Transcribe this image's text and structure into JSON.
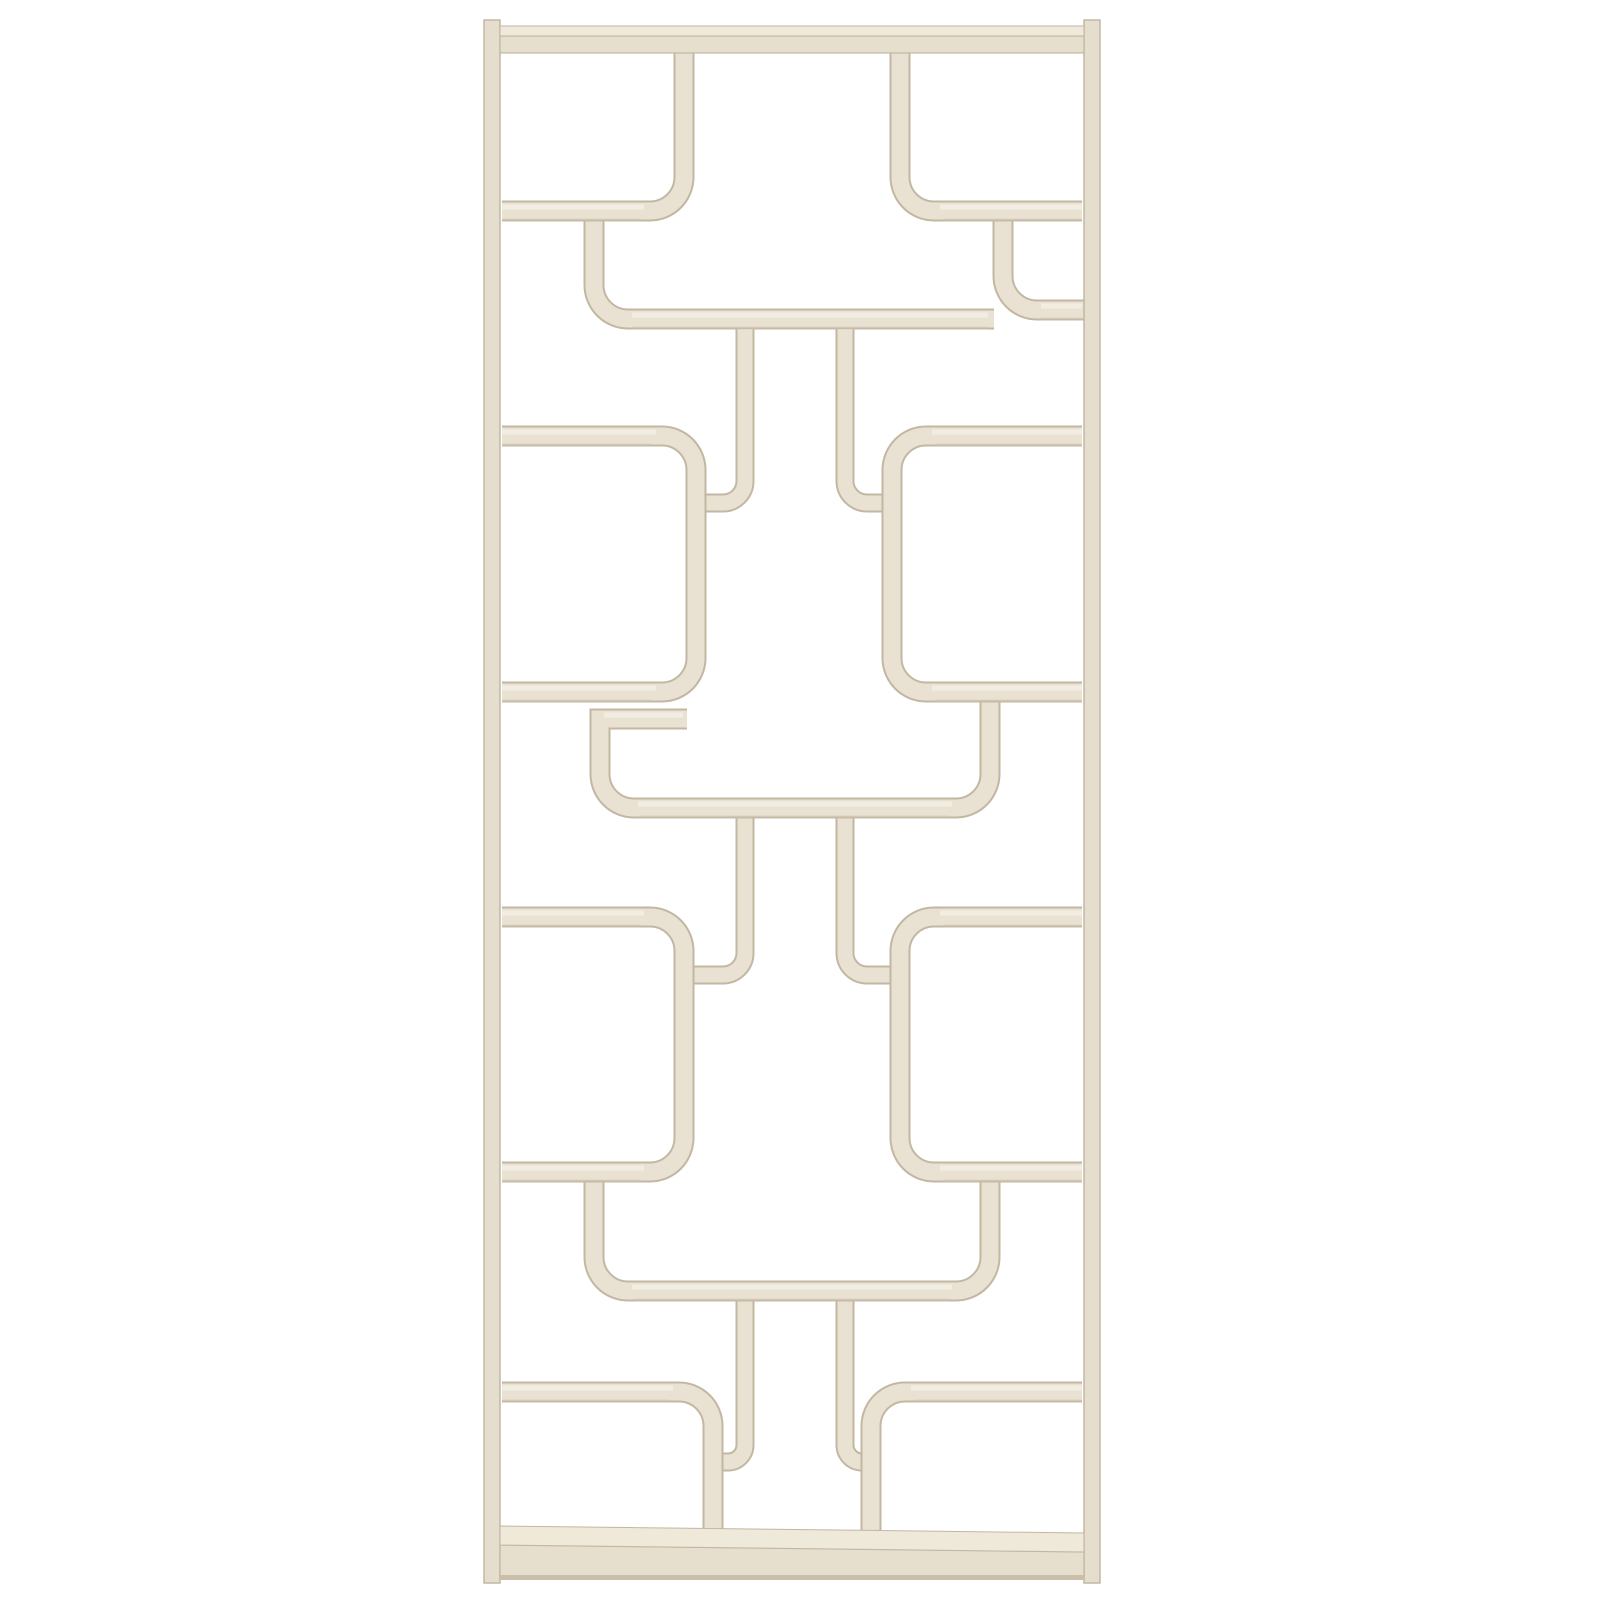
{
  "meta": {
    "subject": "White painted bentwood room divider shelving unit, mid-century modern, product photo on plain white background",
    "canvas_width": 1600,
    "canvas_height": 1600
  },
  "palette": {
    "background": "#ffffff",
    "wood_face": "#e9e2d3",
    "wood_rail": "#e5ddcd",
    "wood_edge": "#c2b7a2",
    "wood_top_face": "#f3efe4",
    "wood_under_shade": "#cdc2ae",
    "bar_top_face": "#efe9da",
    "bar_front_face": "#e7dfce",
    "bar_base": "#c9bfab"
  },
  "divider": {
    "stroke_widths": {
      "shelf": 17,
      "post": 15,
      "outline_extra": 4
    },
    "frame": {
      "rails": [
        {
          "name": "frame-rail-left",
          "x": 484,
          "y": 20,
          "w": 16,
          "h": 1563
        },
        {
          "name": "frame-rail-right",
          "x": 1084,
          "y": 20,
          "w": 16,
          "h": 1563
        }
      ],
      "top_bar": {
        "top_face": {
          "x": 500,
          "y": 26,
          "w": 584,
          "h": 10
        },
        "front_face": {
          "x": 500,
          "y": 36,
          "w": 584,
          "h": 17
        }
      },
      "bottom_bar": {
        "top_face_points": "500,1526 1084,1533 1084,1552 500,1545",
        "front_face_points": "500,1545 1084,1552 1084,1577 500,1577",
        "base": {
          "x": 500,
          "y": 1575,
          "w": 584,
          "h": 5
        }
      }
    },
    "pieces": [
      {
        "name": "band1-hanging-shelf",
        "w": 17,
        "d": "M 594 219 L 594 285 A 34 34 0 0 0 628 319 L 994 319"
      },
      {
        "name": "band1-rail-hook-right",
        "w": 17,
        "d": "M 1003 220 L 1003 276 A 34 34 0 0 0 1037 310 L 1086 310"
      },
      {
        "name": "band2-hook-post-left",
        "w": 15,
        "d": "M 745 329 L 745 481 A 22 22 0 0 1 723 503 L 705 503"
      },
      {
        "name": "band2-hook-post-right",
        "w": 15,
        "d": "M 845 329 L 845 481 A 22 22 0 0 0 867 503 L 883 503"
      },
      {
        "name": "band3-hook-post-left",
        "w": 15,
        "d": "M 745 818 L 745 953 A 22 22 0 0 1 723 975 L 694 975"
      },
      {
        "name": "band3-hook-post-right",
        "w": 15,
        "d": "M 845 818 L 845 953 A 22 22 0 0 0 867 975 L 890 975"
      },
      {
        "name": "band3-center-module",
        "w": 17,
        "d": "M 687 719 L 600 719 L 600 774 A 34 34 0 0 0 634 808 L 956 808 A 34 34 0 0 0 990 774 L 990 700"
      },
      {
        "name": "band5-hook-post-left",
        "w": 15,
        "d": "M 745 1300 L 745 1445 A 17 17 0 0 1 728 1462 L 722 1462"
      },
      {
        "name": "band5-hook-post-right",
        "w": 15,
        "d": "M 845 1300 L 845 1445 A 17 17 0 0 0 862 1462"
      },
      {
        "name": "band5-center-module",
        "w": 17,
        "d": "M 594 1181 L 594 1257 A 34 34 0 0 0 628 1291 L 956 1291 A 34 34 0 0 0 990 1257 L 990 1181"
      },
      {
        "name": "band2-shelf-unit-left",
        "w": 17,
        "d": "M 502 436 L 662 436 A 34 34 0 0 1 696 470 L 696 658 A 34 34 0 0 1 662 692 L 502 692"
      },
      {
        "name": "band2-shelf-unit-right",
        "w": 17,
        "d": "M 1082 436 L 926 436 A 34 34 0 0 0 892 470 L 892 658 A 34 34 0 0 0 926 692 L 1082 692"
      },
      {
        "name": "band4-shelf-unit-left",
        "w": 17,
        "d": "M 502 917 L 650 917 A 34 34 0 0 1 684 951 L 684 1138 A 34 34 0 0 1 650 1172 L 502 1172"
      },
      {
        "name": "band4-shelf-unit-right",
        "w": 17,
        "d": "M 1082 917 L 934 917 A 34 34 0 0 0 900 951 L 900 1138 A 34 34 0 0 0 934 1172 L 1082 1172"
      },
      {
        "name": "band1-shelf-post-left",
        "w": 17,
        "d": "M 502 211 L 650 211 A 34 34 0 0 0 684 177 L 684 50"
      },
      {
        "name": "band1-shelf-post-right",
        "w": 17,
        "d": "M 1082 211 L 934 211 A 34 34 0 0 1 900 177 L 900 50"
      },
      {
        "name": "band5-shelf-post-left",
        "w": 17,
        "d": "M 502 1392 L 679 1392 A 34 34 0 0 1 713 1426 L 713 1548"
      },
      {
        "name": "band5-shelf-post-right",
        "w": 17,
        "d": "M 1082 1392 L 905 1392 A 34 34 0 0 0 871 1426 L 871 1548"
      }
    ],
    "top_highlights": [
      {
        "y": 207,
        "x1": 502,
        "x2": 644
      },
      {
        "y": 207,
        "x1": 940,
        "x2": 1082
      },
      {
        "y": 315,
        "x1": 632,
        "x2": 988
      },
      {
        "y": 306,
        "x1": 1041,
        "x2": 1082
      },
      {
        "y": 432,
        "x1": 502,
        "x2": 656
      },
      {
        "y": 432,
        "x1": 932,
        "x2": 1082
      },
      {
        "y": 688,
        "x1": 502,
        "x2": 656
      },
      {
        "y": 688,
        "x1": 932,
        "x2": 1082
      },
      {
        "y": 715,
        "x1": 604,
        "x2": 683
      },
      {
        "y": 804,
        "x1": 638,
        "x2": 952
      },
      {
        "y": 913,
        "x1": 502,
        "x2": 644
      },
      {
        "y": 913,
        "x1": 940,
        "x2": 1082
      },
      {
        "y": 1168,
        "x1": 502,
        "x2": 644
      },
      {
        "y": 1168,
        "x1": 940,
        "x2": 1082
      },
      {
        "y": 1287,
        "x1": 632,
        "x2": 952
      },
      {
        "y": 1388,
        "x1": 502,
        "x2": 673
      },
      {
        "y": 1388,
        "x1": 911,
        "x2": 1082
      }
    ],
    "under_shadows": [
      {
        "y": 220,
        "x1": 502,
        "x2": 640
      },
      {
        "y": 220,
        "x1": 944,
        "x2": 1082
      },
      {
        "y": 328,
        "x1": 632,
        "x2": 988
      },
      {
        "y": 319,
        "x1": 1041,
        "x2": 1082
      },
      {
        "y": 445,
        "x1": 502,
        "x2": 652
      },
      {
        "y": 445,
        "x1": 936,
        "x2": 1082
      },
      {
        "y": 701,
        "x1": 502,
        "x2": 652
      },
      {
        "y": 701,
        "x1": 936,
        "x2": 1082
      },
      {
        "y": 817,
        "x1": 640,
        "x2": 950
      },
      {
        "y": 926,
        "x1": 502,
        "x2": 640
      },
      {
        "y": 926,
        "x1": 944,
        "x2": 1082
      },
      {
        "y": 1181,
        "x1": 502,
        "x2": 640
      },
      {
        "y": 1181,
        "x1": 944,
        "x2": 1082
      },
      {
        "y": 1300,
        "x1": 634,
        "x2": 950
      },
      {
        "y": 1401,
        "x1": 502,
        "x2": 670
      },
      {
        "y": 1401,
        "x1": 914,
        "x2": 1082
      }
    ]
  }
}
